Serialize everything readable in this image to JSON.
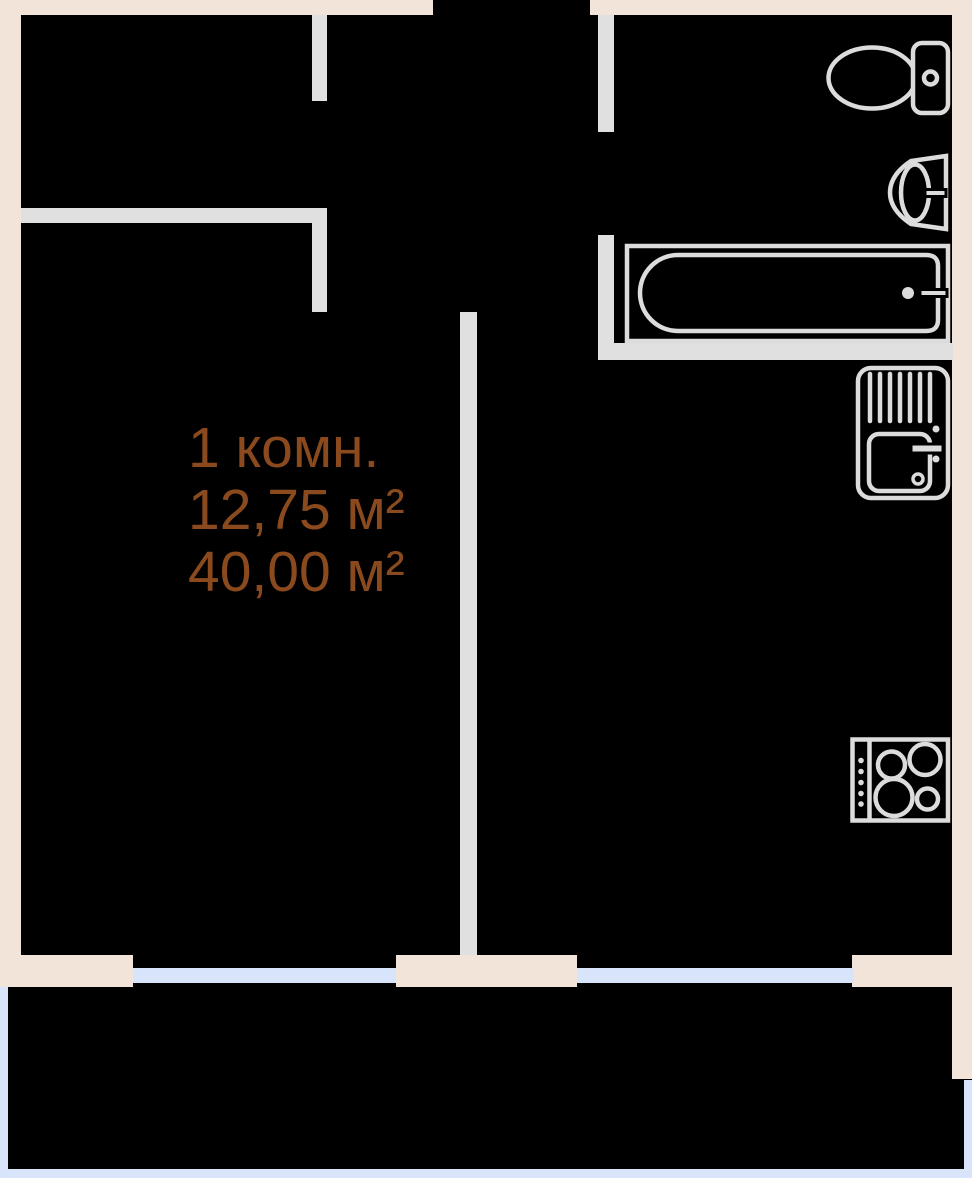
{
  "colors": {
    "background": "#000000",
    "exterior_wall": "#f3e4da",
    "interior_wall": "#e0e0e0",
    "fixture": "#dcdcdc",
    "window": "#d7e4f9",
    "label_text": "#8b4a1d"
  },
  "label": {
    "rooms": "1 комн.",
    "living_area": "12,75 м²",
    "total_area": "40,00 м²"
  },
  "fixtures": [
    {
      "name": "toilet-icon"
    },
    {
      "name": "bathroom-sink-icon"
    },
    {
      "name": "bathtub-icon"
    },
    {
      "name": "kitchen-sink-icon"
    },
    {
      "name": "stove-icon"
    }
  ]
}
